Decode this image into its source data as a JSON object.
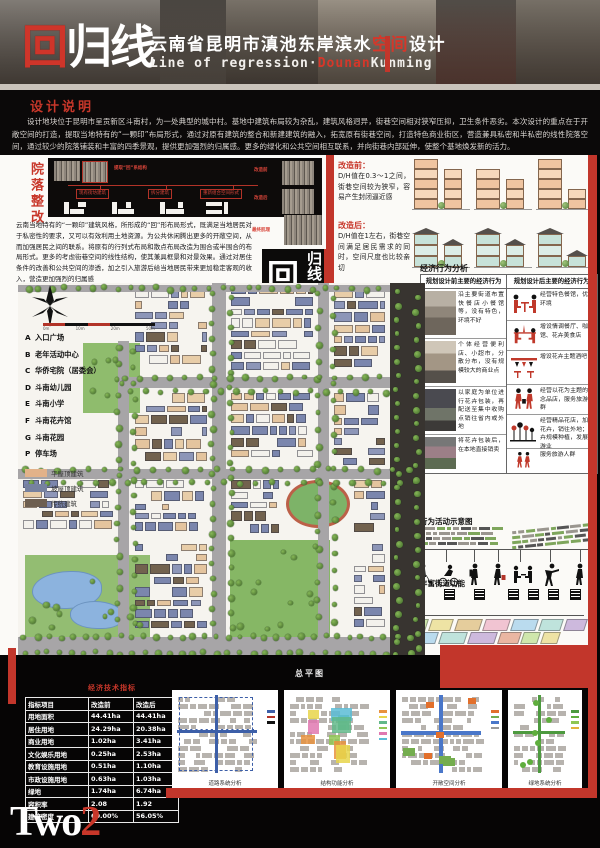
{
  "header": {
    "logo_hui": "回",
    "logo_guixian": "归线",
    "title_pre": "云南省昆明市滇池东岸滨水",
    "title_accent": "空间",
    "title_post": "设计",
    "subtitle_pre": "Line of regression·",
    "subtitle_accent": "Dounan",
    "subtitle_post": "Kunming"
  },
  "design_notes": {
    "title": "设计说明",
    "body": "设计地块位于昆明市呈贡新区斗南村，为一处典型的城中村。基地中建筑布局较为杂乱，建筑风格迥异，街巷空间相对狭窄压抑，卫生条件恶劣。本次设计的重点在于开敞空间的打造，提取当地特有的“一颗印”布局形式，通过对原有建筑的整合和新建建筑的融入，拓宽原有街巷空间，打造特色商业街区，营造兼具私密和半私密的线性院落空间，通过较少的院落铺装和丰富的四季景观，提供更加强烈的归属感。更多的绿化和公共空间相互联系，并向街巷内部延伸，使整个基地焕发新的活力。"
  },
  "courtyard": {
    "vertical_title": "院落整改",
    "labels": {
      "extract": "提取“回”系结构",
      "existing": "现有街坊建筑",
      "split": "拆分建筑",
      "recombine": "重新组合空间形式",
      "before": "改造前",
      "after": "改造后",
      "final": "最终肌理"
    },
    "body": "云南当地特有的“一颗印”建筑风格，所形成的“回”形布局形式，既满足当地居民对于私密性的要求，又可以有效利用土地资源。为公共休闲腾出更多的开敞空间，从而加强居民之间的联系。将原有的行列式布局和散点布局改造为围合或半围合的布局形式。更多的考虑街巷空间的线性结构，使其兼具框景和对景效果。通过对居住条件的改善和公共空间的渗透，加之引入旅游后给当地居民带来更加稳定客观的收入，营造更加强烈的归属感"
  },
  "badge": {
    "hui": "回",
    "guixian": "归线"
  },
  "dh": {
    "before_title": "改造前：",
    "before_text": "D/H值在0.3～1之间，街巷空间较为狭窄，容易产生封闭逼近感",
    "after_title": "改造后：",
    "after_text": "D/H值在1左右，街巷空间满足居民需求的同时，空间尺度也比较亲切"
  },
  "economy": {
    "title": "经济行为分析",
    "col_before": "规划设计前主要的经济行为",
    "col_after": "规划设计后主要的经济行为",
    "before_rows": [
      "沿主要街道布置快餐店小餐馆等，没有特色，环境不好",
      "个体经营便利店、小超市，分散分布，没有规模较大的商业点",
      "以家庭为单位进行花卉包装，再配送至集中收购点销往省内或外地",
      "将花卉包装后，在本地直接销卖"
    ],
    "after_rows": [
      "经营特色餐馆，优化环境",
      "增设情调餐厅、咖啡馆、花卉美食店",
      "增设花卉主题酒吧",
      "经营以花为主题的纪念品店，服务旅游人群",
      "经营精品花店，加工花卉，销往外地；花卉规模种植，发展旅游业",
      "服务旅游人群"
    ],
    "after_icons": [
      "restaurant-diners-icon",
      "cafe-table-icon",
      "bar-rack-icon",
      "souvenir-shoppers-icon",
      "flower-field-icon",
      "tourists-icon"
    ]
  },
  "behavior": {
    "title": "行为活动示意图",
    "figures": [
      "dog-walker-icon",
      "cyclist-icon",
      "backpacker-icon",
      "shopper-icon",
      "diners-icon",
      "exercise-icon",
      "stroller-icon"
    ]
  },
  "street_fn": {
    "title": "丰富街道功能"
  },
  "plan": {
    "caption": "总平图",
    "scale_labels": [
      "0m",
      "10m",
      "20m",
      "50m"
    ],
    "legend": [
      {
        "key": "A",
        "label": "入口广场"
      },
      {
        "key": "B",
        "label": "老年活动中心"
      },
      {
        "key": "C",
        "label": "华侨宅院（居委会）"
      },
      {
        "key": "D",
        "label": "斗南幼儿园"
      },
      {
        "key": "E",
        "label": "斗南小学"
      },
      {
        "key": "F",
        "label": "斗南花卉馆"
      },
      {
        "key": "G",
        "label": "斗南花园"
      },
      {
        "key": "P",
        "label": "停车场"
      }
    ],
    "swatches": [
      {
        "label": "平屋顶建筑",
        "color": "#e2b289"
      },
      {
        "label": "坡屋顶建筑",
        "color": "#76819f"
      },
      {
        "label": "传统建筑",
        "color": "#6e5f50"
      }
    ]
  },
  "indicators": {
    "title": "经济技术指标",
    "headers": [
      "指标项目",
      "改造前",
      "改造后"
    ],
    "rows": [
      [
        "用地面积",
        "44.41ha",
        "44.41ha"
      ],
      [
        "居住用地",
        "24.29ha",
        "20.38ha"
      ],
      [
        "商业用地",
        "1.02ha",
        "3.41ha"
      ],
      [
        "文化娱乐用地",
        "0.25ha",
        "2.53ha"
      ],
      [
        "教育设施用地",
        "0.51ha",
        "1.10ha"
      ],
      [
        "市政设施用地",
        "0.63ha",
        "1.03ha"
      ],
      [
        "绿地",
        "1.74ha",
        "6.74ha"
      ],
      [
        "容积率",
        "2.08",
        "1.92"
      ],
      [
        "建筑密度",
        "60.00%",
        "56.05%"
      ]
    ]
  },
  "analysis_cards": [
    {
      "caption": "道路系统分析"
    },
    {
      "caption": "结构功能分析"
    },
    {
      "caption": "开敞空间分析"
    },
    {
      "caption": "绿地系统分析"
    }
  ],
  "footer": {
    "logo_text": "Two",
    "logo_digit": "2"
  },
  "colors": {
    "accent_red": "#c2362b",
    "flat_roof": "#e2b289",
    "pitched_roof": "#76819f",
    "traditional": "#6e5f50",
    "before_building": "#f4cfae",
    "after_building": "#cfe6dd"
  }
}
